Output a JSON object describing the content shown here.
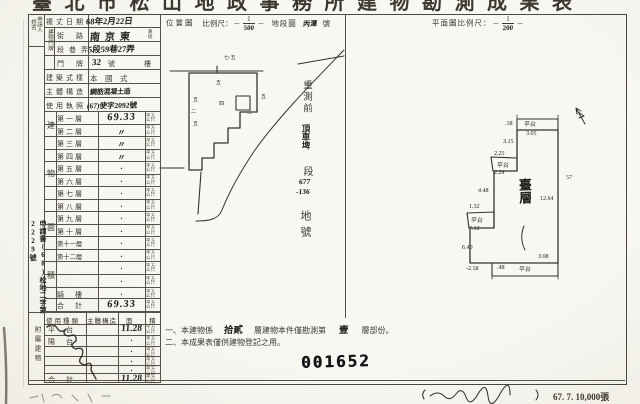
{
  "page": {
    "title_cropped": "臺北市松山地政事務所建物勘測成果表",
    "serial_stamp": "001652",
    "print_info": "67. 7. 10,000張",
    "paper_color": "#f8f7f2",
    "ink_color": "#34332c"
  },
  "form": {
    "applicant_label_1": "申請人",
    "applicant_label_2": "姓名",
    "door_group": "建物門牌",
    "margin_note": "申請書(68)松地二字第2229號",
    "rows": {
      "survey_date": {
        "label": "複丈日期",
        "value": "68年2月22日"
      },
      "street": {
        "label": "街路",
        "value": "南京東",
        "suffix_1": "路",
        "suffix_2": "街"
      },
      "section": {
        "label": "段巷弄",
        "value": "5段59巷27弄"
      },
      "door": {
        "label": "門牌",
        "value": "32",
        "suffix": "號",
        "floor_suffix": "樓"
      },
      "style": {
        "label": "建築式樣",
        "value": "本　國　式"
      },
      "structure": {
        "label": "主體構造",
        "value": "鋼筋混凝土造"
      },
      "license": {
        "label": "使用執照",
        "value": "(67)使字2092號"
      }
    }
  },
  "floor_area": {
    "group_label": "建物面積",
    "unit": "平方公尺",
    "rows": [
      {
        "label": "第一層",
        "value": "69.33"
      },
      {
        "label": "第二層",
        "value": "〃"
      },
      {
        "label": "第三層",
        "value": "〃"
      },
      {
        "label": "第四層",
        "value": "〃"
      },
      {
        "label": "第五層",
        "value": "・"
      },
      {
        "label": "第六層",
        "value": "・"
      },
      {
        "label": "第七層",
        "value": "・"
      },
      {
        "label": "第八層",
        "value": "・"
      },
      {
        "label": "第九層",
        "value": "・"
      },
      {
        "label": "第十層",
        "value": "・"
      },
      {
        "label": "第十一層",
        "value": "・"
      },
      {
        "label": "第十二層",
        "value": "・"
      },
      {
        "label": "",
        "value": "・"
      },
      {
        "label": "",
        "value": "・"
      },
      {
        "label": "騎　樓",
        "value": "・"
      },
      {
        "label": "合　計",
        "value": "69.33"
      }
    ]
  },
  "annex": {
    "group_label": "附屬建物",
    "header": [
      "使用種類",
      "主體構造",
      "面",
      "積"
    ],
    "unit": "平方公尺",
    "rows": [
      {
        "label": "平　台",
        "value": "11.28"
      },
      {
        "label": "陽　台",
        "value": "・"
      },
      {
        "label": "",
        "value": "・"
      },
      {
        "label": "",
        "value": "・"
      },
      {
        "label": "",
        "value": "・"
      },
      {
        "label": "合　計",
        "value": "11.28"
      }
    ]
  },
  "location_map": {
    "title": "位置圖",
    "scale_label": "比例尺：",
    "scale_num": "1",
    "scale_den": "500",
    "sheet_label": "地段圖",
    "sheet_value": "丙潭",
    "sheet_suffix": "號",
    "pre_survey": {
      "prefix": "重測前",
      "section": "頂車埤",
      "section_unit": "段",
      "lot_line1": "677",
      "lot_line2": "-136",
      "label": "地號"
    },
    "labels": [
      {
        "t": "七-五",
        "x": 224,
        "y": 54
      },
      {
        "t": "五",
        "x": 216,
        "y": 79
      },
      {
        "t": "四",
        "x": 219,
        "y": 100
      },
      {
        "t": "五",
        "x": 193,
        "y": 96
      },
      {
        "t": "二",
        "x": 191,
        "y": 108
      },
      {
        "t": "五",
        "x": 193,
        "y": 120
      },
      {
        "t": "五",
        "x": 261,
        "y": 93
      },
      {
        "t": "二",
        "x": 247,
        "y": 109
      }
    ]
  },
  "floor_plan": {
    "title": "平面圖比例尺：",
    "scale_num": "1",
    "scale_den": "200",
    "room_label": "臺層",
    "annotations": [
      {
        "t": ".58",
        "x": 505,
        "y": 121
      },
      {
        "t": "平台",
        "x": 524,
        "y": 119,
        "c": "lab"
      },
      {
        "t": "3.05",
        "x": 526,
        "y": 131
      },
      {
        "t": "3.15",
        "x": 503,
        "y": 139
      },
      {
        "t": "2.25",
        "x": 494,
        "y": 151
      },
      {
        "t": "平台",
        "x": 497,
        "y": 160,
        "c": "lab"
      },
      {
        "t": "2.24",
        "x": 494,
        "y": 170
      },
      {
        "t": "4.48",
        "x": 478,
        "y": 188
      },
      {
        "t": "12.64",
        "x": 540,
        "y": 196
      },
      {
        "t": "1.32",
        "x": 469,
        "y": 204
      },
      {
        "t": "平台",
        "x": 471,
        "y": 215,
        "c": "lab"
      },
      {
        "t": "7.12",
        "x": 469,
        "y": 226
      },
      {
        "t": "6.40",
        "x": 462,
        "y": 245
      },
      {
        "t": "-2.58",
        "x": 466,
        "y": 266
      },
      {
        "t": ".48",
        "x": 497,
        "y": 265
      },
      {
        "t": "平台",
        "x": 519,
        "y": 264,
        "c": "lab"
      },
      {
        "t": "3.08",
        "x": 538,
        "y": 254
      },
      {
        "t": "57",
        "x": 566,
        "y": 175
      }
    ]
  },
  "notes": {
    "no1_pre": "一、本建物係",
    "no1_fill1": "拾貳",
    "no1_mid": "層建物本件僅勘測第",
    "no1_fill2": "壹",
    "no1_post": "層部份。",
    "no2": "二、本成果表僅供建物登記之用。"
  }
}
